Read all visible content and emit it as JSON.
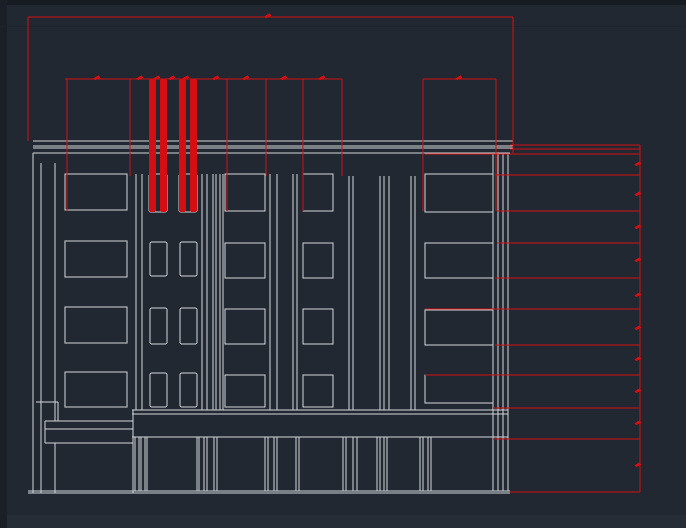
{
  "canvas": {
    "width": 686,
    "height": 528,
    "colors": {
      "background": "#222831",
      "top_edge_shade": "#171c23",
      "left_edge_shade": "#1b2028",
      "faint_guide_line": "#1d222b",
      "bottom_strip": "#272d36",
      "facade_line": "#d2d7dc",
      "dimension_red": "#d40e12"
    },
    "edge_shades": {
      "top": [
        0,
        0,
        686,
        5
      ],
      "left": [
        0,
        0,
        7,
        528
      ],
      "faint_line": [
        0,
        26,
        686,
        1
      ],
      "bottom": [
        0,
        515,
        686,
        13
      ]
    }
  },
  "elevation": {
    "h_lines": [
      [
        33,
        141,
        513
      ],
      [
        33,
        146,
        513
      ],
      [
        33,
        148,
        513
      ],
      [
        33,
        153,
        510
      ],
      [
        132,
        410,
        508
      ],
      [
        132,
        414,
        508
      ],
      [
        132,
        437,
        508
      ],
      [
        36,
        402,
        58
      ],
      [
        45,
        421,
        133
      ],
      [
        45,
        429,
        133
      ],
      [
        45,
        443,
        133
      ],
      [
        28,
        491,
        510
      ],
      [
        28,
        493,
        510
      ]
    ],
    "v_lines": [
      [
        33,
        153,
        493
      ],
      [
        41,
        163,
        493
      ],
      [
        55,
        163,
        421
      ],
      [
        58,
        402,
        421
      ],
      [
        45,
        421,
        443
      ],
      [
        55,
        443,
        493
      ],
      [
        133,
        410,
        493
      ],
      [
        136,
        174,
        410
      ],
      [
        142,
        174,
        410
      ],
      [
        202,
        174,
        410
      ],
      [
        207,
        174,
        410
      ],
      [
        213,
        174,
        410
      ],
      [
        216,
        174,
        410
      ],
      [
        220,
        174,
        410
      ],
      [
        223,
        174,
        410
      ],
      [
        270,
        174,
        410
      ],
      [
        277,
        174,
        410
      ],
      [
        293,
        174,
        410
      ],
      [
        297,
        174,
        410
      ],
      [
        349,
        176,
        410
      ],
      [
        353,
        176,
        410
      ],
      [
        380,
        176,
        410
      ],
      [
        384,
        176,
        410
      ],
      [
        389,
        176,
        410
      ],
      [
        411,
        176,
        410
      ],
      [
        415,
        176,
        410
      ],
      [
        493,
        153,
        491
      ],
      [
        498,
        153,
        491
      ],
      [
        503,
        153,
        491
      ],
      [
        508,
        153,
        491
      ],
      [
        135,
        437,
        491
      ],
      [
        139,
        437,
        491
      ],
      [
        141,
        437,
        491
      ],
      [
        145,
        437,
        491
      ],
      [
        147,
        437,
        491
      ],
      [
        197,
        437,
        491
      ],
      [
        199,
        437,
        491
      ],
      [
        204,
        437,
        491
      ],
      [
        207,
        437,
        491
      ],
      [
        214,
        437,
        491
      ],
      [
        217,
        437,
        491
      ],
      [
        265,
        437,
        491
      ],
      [
        268,
        437,
        491
      ],
      [
        274,
        437,
        491
      ],
      [
        277,
        437,
        491
      ],
      [
        296,
        437,
        491
      ],
      [
        299,
        437,
        491
      ],
      [
        343,
        437,
        491
      ],
      [
        346,
        437,
        491
      ],
      [
        353,
        437,
        491
      ],
      [
        357,
        437,
        491
      ],
      [
        377,
        437,
        491
      ],
      [
        380,
        437,
        491
      ],
      [
        384,
        437,
        491
      ],
      [
        387,
        437,
        491
      ],
      [
        420,
        437,
        491
      ],
      [
        423,
        437,
        491
      ],
      [
        428,
        437,
        491
      ],
      [
        431,
        437,
        491
      ]
    ],
    "windows": [
      [
        65,
        174,
        62,
        36
      ],
      [
        65,
        241,
        62,
        36
      ],
      [
        65,
        307,
        62,
        36
      ],
      [
        65,
        372,
        62,
        35
      ],
      [
        225,
        174,
        40,
        37
      ],
      [
        225,
        243,
        40,
        35
      ],
      [
        225,
        309,
        40,
        35
      ],
      [
        225,
        375,
        40,
        32
      ],
      [
        303,
        174,
        30,
        37
      ],
      [
        303,
        243,
        30,
        35
      ],
      [
        303,
        309,
        30,
        35
      ],
      [
        303,
        375,
        30,
        32
      ],
      [
        425,
        174,
        68,
        38
      ],
      [
        425,
        243,
        68,
        35
      ],
      [
        425,
        310,
        68,
        35
      ],
      [
        425,
        375,
        68,
        28
      ]
    ],
    "small_windows": [
      [
        149,
        174,
        18,
        38
      ],
      [
        179,
        174,
        18,
        38
      ],
      [
        150,
        242,
        17,
        34
      ],
      [
        180,
        242,
        17,
        34
      ],
      [
        150,
        308,
        17,
        36
      ],
      [
        180,
        308,
        17,
        36
      ],
      [
        150,
        373,
        17,
        34
      ],
      [
        180,
        373,
        17,
        34
      ]
    ]
  },
  "dimensions": {
    "h_lines": [
      [
        28,
        17,
        513
      ],
      [
        65,
        79,
        342
      ],
      [
        423,
        79,
        496
      ],
      [
        510,
        145,
        640
      ],
      [
        510,
        149,
        640
      ],
      [
        425,
        154,
        640
      ],
      [
        495,
        175,
        640
      ],
      [
        497,
        211,
        640
      ],
      [
        497,
        243,
        640
      ],
      [
        495,
        278,
        640
      ],
      [
        425,
        309,
        640
      ],
      [
        495,
        345,
        640
      ],
      [
        425,
        375,
        640
      ],
      [
        493,
        408,
        640
      ],
      [
        493,
        439,
        640
      ],
      [
        510,
        492,
        640
      ]
    ],
    "v_lines": [
      [
        28,
        17,
        141
      ],
      [
        513,
        17,
        153
      ],
      [
        640,
        145,
        492
      ],
      [
        67,
        79,
        211
      ],
      [
        130,
        79,
        176
      ],
      [
        227,
        79,
        211
      ],
      [
        266,
        79,
        176
      ],
      [
        303,
        79,
        211
      ],
      [
        342,
        79,
        176
      ],
      [
        423,
        79,
        211
      ],
      [
        496,
        79,
        211
      ]
    ],
    "bars": [
      [
        149,
        79,
        7,
        133
      ],
      [
        160,
        79,
        7,
        133
      ],
      [
        179,
        79,
        7,
        133
      ],
      [
        190,
        79,
        7,
        133
      ]
    ],
    "marks": [
      [
        268,
        16
      ],
      [
        97,
        78
      ],
      [
        140,
        78
      ],
      [
        157,
        78
      ],
      [
        172,
        78
      ],
      [
        186,
        78
      ],
      [
        216,
        78
      ],
      [
        246,
        78
      ],
      [
        284,
        78
      ],
      [
        322,
        78
      ],
      [
        459,
        78
      ],
      [
        638,
        164
      ],
      [
        638,
        194
      ],
      [
        638,
        227
      ],
      [
        638,
        260
      ],
      [
        638,
        295
      ],
      [
        638,
        328
      ],
      [
        638,
        359
      ],
      [
        638,
        391
      ],
      [
        638,
        423
      ],
      [
        638,
        465
      ]
    ]
  }
}
